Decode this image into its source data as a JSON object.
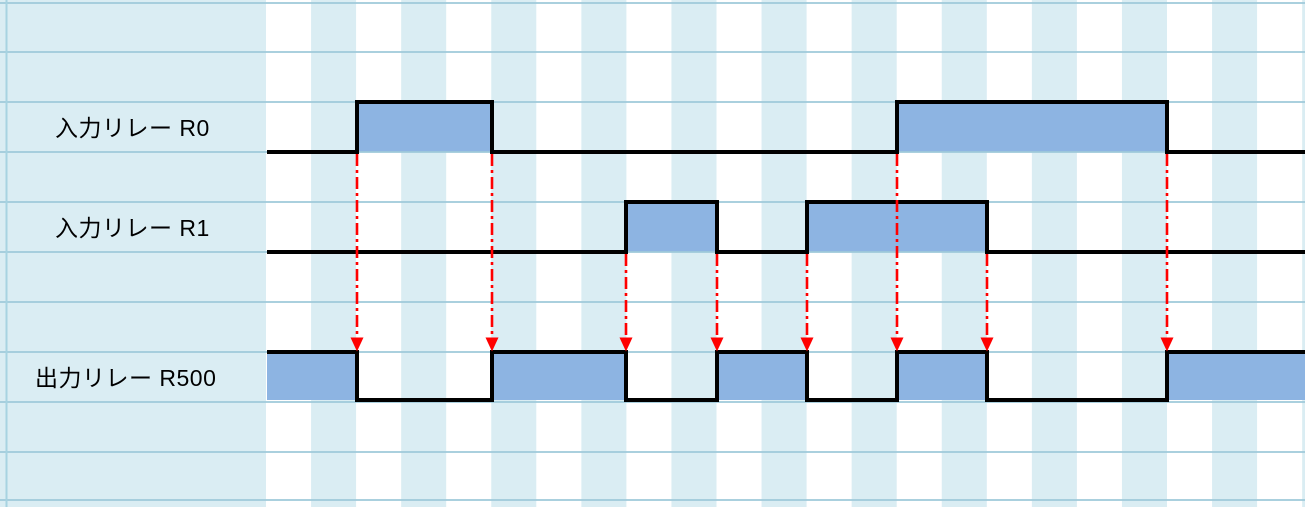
{
  "diagram": {
    "type": "timing-diagram",
    "width": 1305,
    "height": 507,
    "x_start": 267,
    "x_end": 1305,
    "signals": [
      {
        "id": "R0",
        "label": "入力リレー R0",
        "kind": "input",
        "high_y": 102,
        "baseline_y": 152,
        "high_segments_x": [
          [
            357,
            492
          ],
          [
            897,
            1167
          ]
        ]
      },
      {
        "id": "R1",
        "label": "入力リレー R1",
        "kind": "input",
        "high_y": 202,
        "baseline_y": 252,
        "high_segments_x": [
          [
            626,
            717
          ],
          [
            807,
            987
          ]
        ]
      },
      {
        "id": "R500",
        "label": "出力リレー R500",
        "kind": "output",
        "high_y": 352,
        "baseline_y": 400,
        "high_segments_x": [
          [
            267,
            357
          ],
          [
            492,
            626
          ],
          [
            717,
            807
          ],
          [
            897,
            987
          ],
          [
            1167,
            1305
          ]
        ]
      }
    ],
    "arrows": [
      {
        "x": 357,
        "y_from": 154,
        "y_to": 352
      },
      {
        "x": 492,
        "y_from": 154,
        "y_to": 352
      },
      {
        "x": 626,
        "y_from": 254,
        "y_to": 352
      },
      {
        "x": 717,
        "y_from": 254,
        "y_to": 352
      },
      {
        "x": 807,
        "y_from": 254,
        "y_to": 352
      },
      {
        "x": 897,
        "y_from": 154,
        "y_to": 352
      },
      {
        "x": 987,
        "y_from": 254,
        "y_to": 352
      },
      {
        "x": 1167,
        "y_from": 154,
        "y_to": 352
      }
    ],
    "grid": {
      "h_lines_y": [
        3,
        52,
        102,
        152,
        202,
        252,
        302,
        352,
        402,
        452,
        500
      ],
      "stripe_start_x": 266,
      "stripe_width": 45.05,
      "stripe_count": 24,
      "label_panel_width": 266,
      "left_border_x": 6.5
    },
    "colors": {
      "background": "#ffffff",
      "stripe": "#daedf3",
      "label_panel": "#daedf3",
      "gridline": "#9ec9da",
      "left_border": "#a7d3e1",
      "signal_fill": "#8db4e2",
      "signal_line": "#000000",
      "arrow": "#ff0000",
      "label_text": "#000000"
    }
  }
}
